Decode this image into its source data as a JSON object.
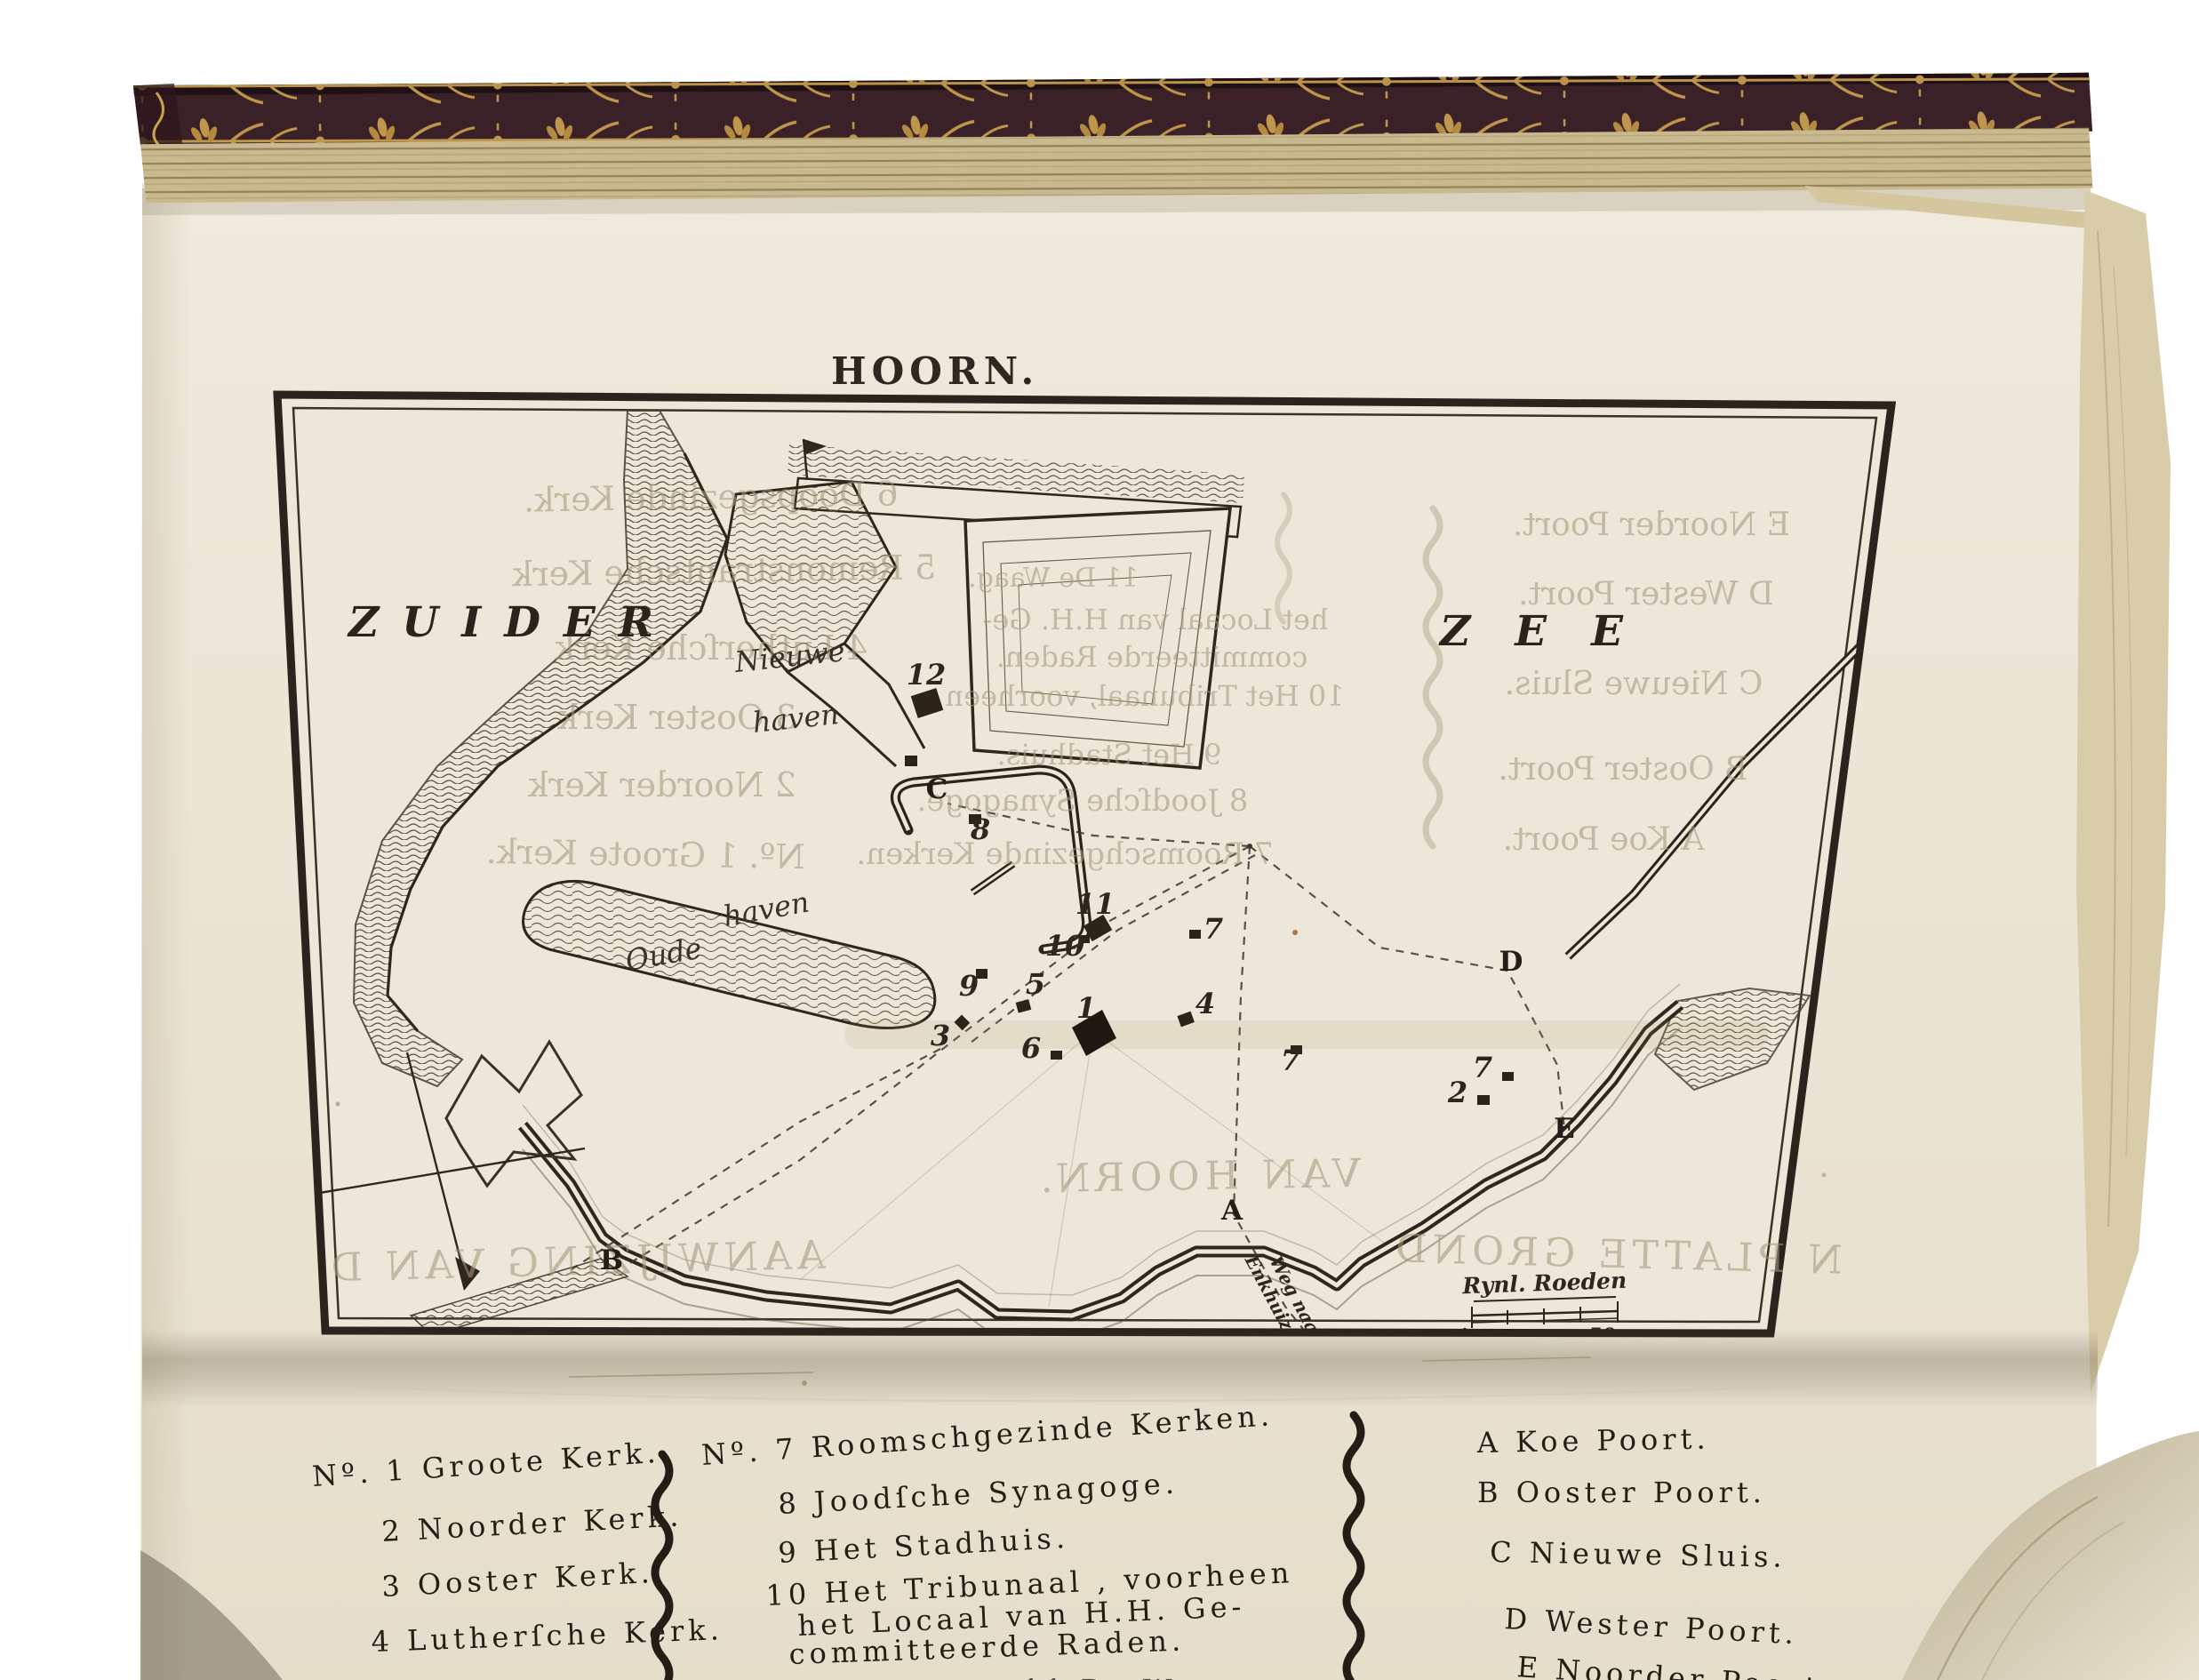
{
  "plate": {
    "title": "HOORN.",
    "sea_left": "ZUIDER",
    "sea_right": "ZEE",
    "nieuwe_haven": {
      "line1": "Nieuwe",
      "line2": "haven"
    },
    "oude_haven": {
      "line1": "Oude",
      "line2": "haven"
    },
    "road_label": {
      "line1": "Weg naar",
      "line2": "Enkhuizen"
    },
    "scale": {
      "label": "Rynl. Roeden",
      "tick_mid": "25",
      "tick_end": "50"
    },
    "markers": {
      "n12": "12",
      "n11": "11",
      "n10": "10",
      "n9": "9",
      "n8": "8",
      "n7a": "7",
      "n7b": "7",
      "n7c": "7",
      "n6": "6",
      "n5": "5",
      "n4": "4",
      "n3": "3",
      "n2": "2",
      "n1": "1",
      "gA": "A",
      "gB": "B",
      "gC": "C",
      "gD": "D",
      "gE": "E"
    }
  },
  "bleedthrough": {
    "left": [
      "6 Doopsgezinde Kerk.",
      "5 Remonstrantsche Kerk",
      "4 Lutherſche Kerk",
      "3 Ooster Kerk",
      "2 Noorder Kerk",
      "Nº. 1 Groote Kerk."
    ],
    "center": [
      "11 De Waag.",
      "het Locaal van H.H. Ge-",
      "committeerde Raden.",
      "10 Het Tribunaal, voorheen",
      "9 Het Stadhuis.",
      "8 Joodſche Synagoge.",
      "7 Roomschgezinde Kerken."
    ],
    "right": [
      "E Noorder Poort.",
      "D Wester Poort.",
      "C Nieuwe Sluis.",
      "B Ooster Poort.",
      "A Koe Poort."
    ],
    "bottom": [
      "AANWIJZING VAN D",
      "VAN HOORN.",
      "N PLATTE GROND"
    ]
  },
  "legend": {
    "col1": [
      "Nº. 1 Groote Kerk.",
      "2 Noorder Kerk.",
      "3 Ooster Kerk.",
      "4 Lutherſche Kerk."
    ],
    "col2": [
      "Nº. 7 Roomschgezinde Kerken.",
      "8 Joodſche Synagoge.",
      "9 Het Stadhuis.",
      "10 Het Tribunaal , voorheen",
      "het Locaal van H.H. Ge-",
      "committeerde Raden."
    ],
    "col2_partial": "11 De Waag.",
    "col3": [
      "A Koe Poort.",
      "B Ooster Poort.",
      "C Nieuwe Sluis.",
      "D Wester Poort.",
      "E Noorder Poort."
    ]
  }
}
